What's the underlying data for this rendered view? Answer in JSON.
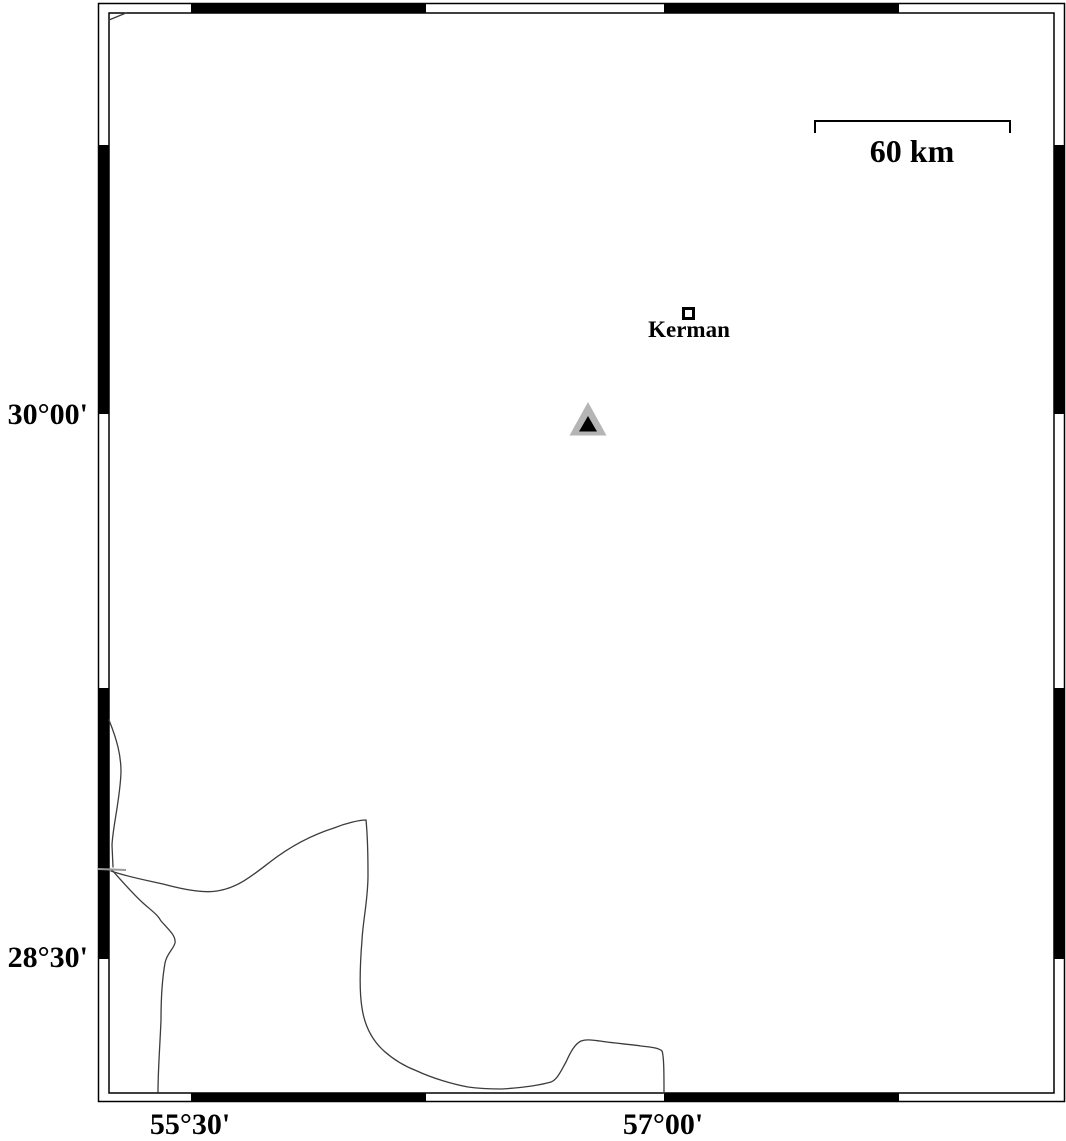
{
  "frame": {
    "lat_labels": {
      "top": "30°00'",
      "bottom": "28°30'"
    },
    "lon_labels": {
      "left": "55°30'",
      "right": "57°00'"
    }
  },
  "scale_bar": {
    "label": "60 km",
    "length_km": 60
  },
  "city": {
    "name": "Kerman"
  },
  "markers": {
    "city_marker": "open-square",
    "triangle_marker": "gray-triangle-with-black-core"
  },
  "colors": {
    "frame_band": "#000000",
    "map_line": "#3c3c3c",
    "boundary_stub_gray": "#999999",
    "triangle_gray": "#b5b5b5",
    "triangle_core": "#000000",
    "background": "#ffffff"
  }
}
